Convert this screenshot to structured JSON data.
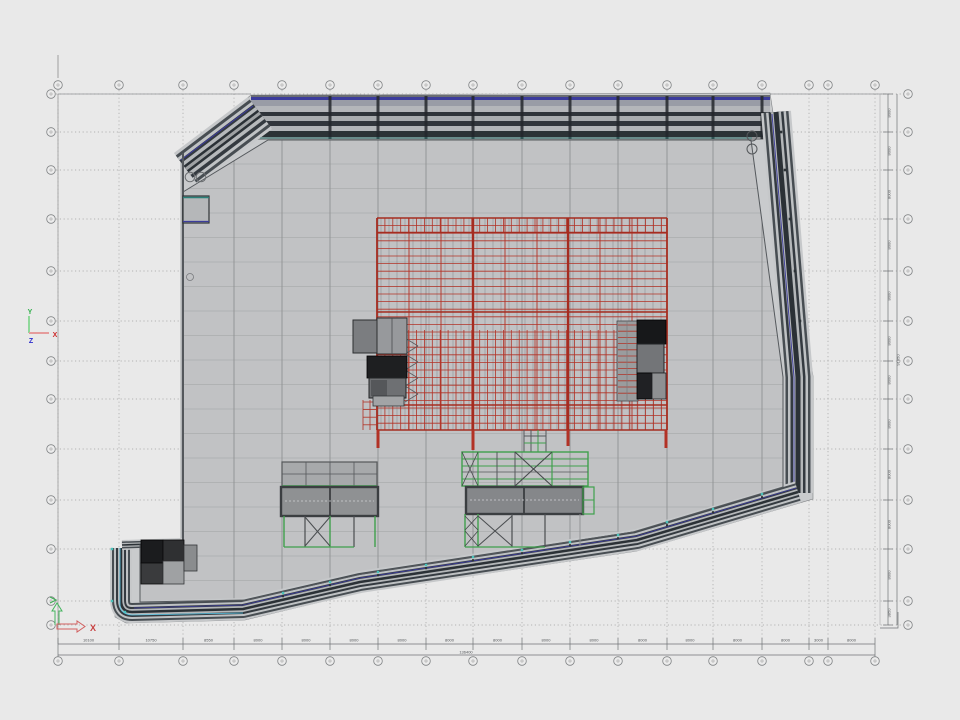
{
  "viewport": {
    "background": "#e9e9e9"
  },
  "drawing": {
    "floor_color": "#c1c2c4",
    "band_light": "#c6c8ca",
    "band_dark": "#474d52",
    "band_darker": "#2b3136",
    "accent_blue": "#3c3c9c",
    "accent_teal": "#2a8078",
    "accent_cyan": "#49c2ba",
    "grid_red": "#b23226",
    "structure_green": "#3fa04c",
    "dim_color": "#55585b"
  },
  "ucs": {
    "model": {
      "x": "X",
      "y": "Y",
      "z": "Z"
    },
    "layout": {
      "x": "X"
    }
  },
  "dimensions": {
    "bottom": {
      "segments": [
        "10100",
        "10750",
        "8550",
        "8000",
        "8000",
        "8000",
        "8000",
        "8000",
        "8000",
        "8000",
        "8000",
        "8000",
        "8000",
        "8000",
        "8000",
        "3000",
        "8000"
      ],
      "total": "136400"
    },
    "right": {
      "segments": [
        "8000",
        "8000",
        "8000",
        "8000",
        "8000",
        "8000",
        "8000",
        "8000",
        "8000",
        "8000",
        "8000",
        "3850"
      ],
      "total": "91850"
    }
  }
}
